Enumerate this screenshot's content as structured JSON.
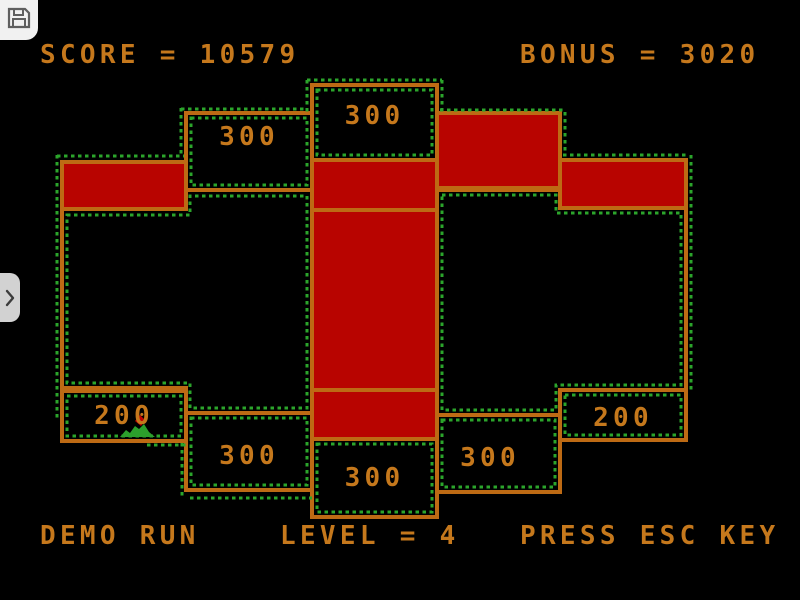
{
  "emulator": {
    "save_button": {
      "icon": "floppy-icon"
    },
    "side_panel_handle": {
      "icon": "chevron-right-icon"
    }
  },
  "hud": {
    "score_line": "SCORE = 10579",
    "bonus_line": "BONUS = 3020",
    "demo_text": "DEMO RUN",
    "level_line": "LEVEL = 4",
    "esc_text": "PRESS ESC KEY"
  },
  "game": {
    "score": 10579,
    "bonus": 3020,
    "level": 4,
    "mode": "DEMO RUN",
    "colors": {
      "wall": "#bd6a14",
      "captured_fill": "#b80400",
      "trail_dots": "#2ba52b",
      "text": "#c5781c",
      "background": "#000000",
      "sprite_body": "#2ca02c",
      "sprite_dot": "#c00000"
    },
    "zones": [
      {
        "id": "top-left-zone",
        "label": "300"
      },
      {
        "id": "top-center-zone",
        "label": "300"
      },
      {
        "id": "left-200-zone",
        "label": "200"
      },
      {
        "id": "bottom-left-zone",
        "label": "300"
      },
      {
        "id": "bottom-center-zone",
        "label": "300"
      },
      {
        "id": "bottom-right-zone",
        "label": "300"
      },
      {
        "id": "right-200-zone",
        "label": "200"
      }
    ]
  }
}
